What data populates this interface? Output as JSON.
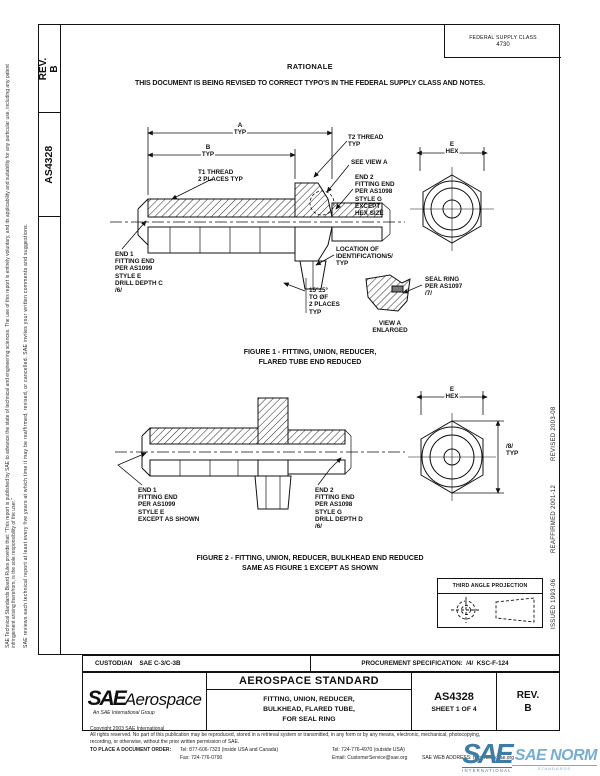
{
  "margins": {
    "left_disclaimer_1": "SAE Technical Standards Board Rules provide that: \"This report is published by SAE to advance the state of technical and engineering sciences. The use of this report is entirely voluntary, and its applicability and suitability for any particular use, including any patent infringement arising therefrom, is the sole responsibility of the user.\"",
    "left_disclaimer_2": "SAE reviews each technical report at least every five years at which time it may be reaffirmed, revised, or cancelled. SAE invites your written comments and suggestions.",
    "revised": "REVISED 2003-08",
    "reaffirmed": "REAFFIRMED 2001-12",
    "issued": "ISSUED 1993-06"
  },
  "sidebar": {
    "rev": "REV.\nB",
    "doc_number": "AS4328"
  },
  "header": {
    "fsc_label": "FEDERAL SUPPLY CLASS",
    "fsc_value": "4730",
    "rationale_title": "RATIONALE",
    "rationale_text": "THIS DOCUMENT IS BEING REVISED TO CORRECT TYPO'S IN THE FEDERAL SUPPLY CLASS AND NOTES."
  },
  "figure1": {
    "labels": {
      "dim_a": "A\nTYP",
      "dim_b": "B\nTYP",
      "t1_thread": "T1 THREAD\n2 PLACES TYP",
      "t2_thread": "T2 THREAD\nTYP",
      "see_view_a": "SEE VIEW A",
      "end2": "END 2\nFITTING END\nPER AS1098\nSTYLE G\nEXCEPT\nHEX SIZE",
      "e_hex": "E\nHEX",
      "end1": "END 1\nFITTING END\nPER AS1099\nSTYLE E\nDRILL DEPTH C\n/6/",
      "location_id": "LOCATION OF\nIDENTIFICATION/5/\nTYP",
      "angle": "15°±5°\nTO ØF\n2 PLACES\nTYP",
      "seal_ring": "SEAL RING\nPER AS1097\n/7/",
      "view_a": "VIEW A\nENLARGED"
    },
    "caption": "FIGURE 1 - FITTING, UNION, REDUCER,\nFLARED TUBE END REDUCED"
  },
  "figure2": {
    "labels": {
      "e_hex": "E\nHEX",
      "dim_8": "/8/\nTYP",
      "end1": "END 1\nFITTING END\nPER AS1099\nSTYLE E\nEXCEPT AS SHOWN",
      "end2": "END 2\nFITTING END\nPER AS1098\nSTYLE G\nDRILL DEPTH D\n/6/"
    },
    "caption": "FIGURE 2 - FITTING, UNION, REDUCER, BULKHEAD END REDUCED\nSAME AS FIGURE 1 EXCEPT AS SHOWN"
  },
  "projection": {
    "label": "THIRD ANGLE PROJECTION"
  },
  "info_row": {
    "custodian": "CUSTODIAN    SAE C-3/C-3B",
    "procurement": "PROCUREMENT SPECIFICATION:  /4/  KSC-F-124"
  },
  "title_block": {
    "brand": "SAE",
    "brand2": "Aerospace",
    "brand_sub": "An SAE International Group",
    "type": "AEROSPACE STANDARD",
    "title": "FITTING, UNION, REDUCER,\nBULKHEAD, FLARED TUBE,\nFOR SEAL RING",
    "number": "AS4328",
    "sheet": "SHEET 1 OF 4",
    "rev_label": "REV.",
    "rev_value": "B"
  },
  "footer": {
    "copyright": "Copyright 2003 SAE International",
    "rights_1": "All rights reserved. No part of this publication may be reproduced, stored in a retrieval system or transmitted, in any form or by any means, electronic, mechanical, photocopying,",
    "rights_2": "recording, or otherwise, without the prior written permission of SAE.",
    "order_label": "TO PLACE A DOCUMENT ORDER:",
    "tel_inside": "Tel: 877-606-7323 (inside USA and Canada)",
    "tel_outside": "Tel: 724-776-4970 (outside USA)",
    "fax": "Fax: 724-776-0790",
    "email": "Email: CustomerService@sae.org",
    "web": "SAE WEB ADDRESS: http://www.sae.org"
  },
  "watermark": {
    "sae": "SAE",
    "sae_sub": "INTERNATIONAL",
    "norm": "SAE NORM",
    "norm_sub": "STANDARDS",
    "color_dark": "#3E7CA6",
    "color_light": "#74AED2"
  }
}
